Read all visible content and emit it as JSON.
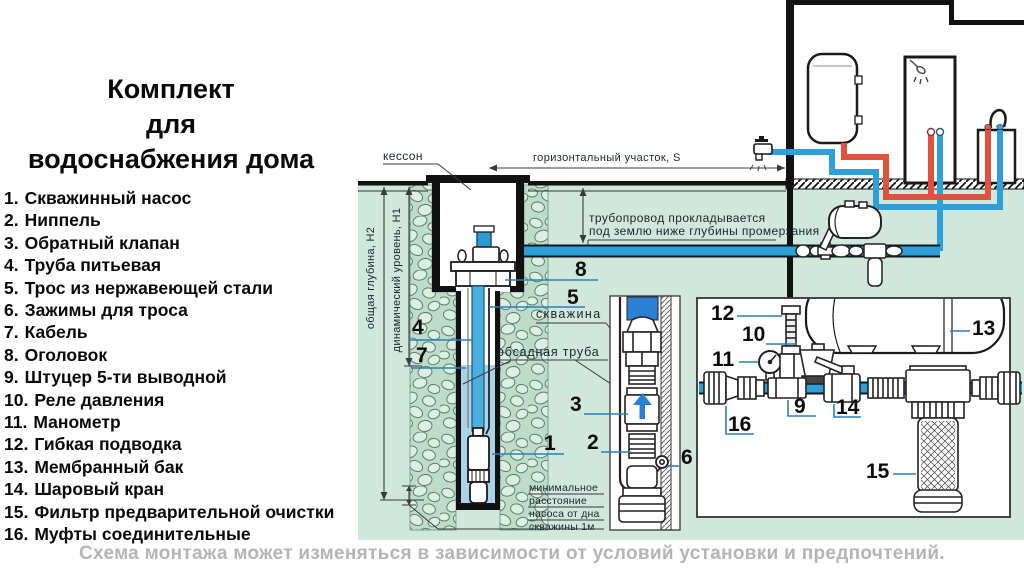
{
  "title": {
    "lines": [
      "Комплект",
      "для",
      "водоснабжения дома"
    ]
  },
  "parts_list": [
    {
      "num": "1.",
      "label": "Скважинный насос"
    },
    {
      "num": "2.",
      "label": "Ниппель"
    },
    {
      "num": "3.",
      "label": "Обратный клапан"
    },
    {
      "num": "4.",
      "label": "Труба питьевая"
    },
    {
      "num": "5.",
      "label": "Трос из нержавеющей стали"
    },
    {
      "num": "6.",
      "label": "Зажимы для троса"
    },
    {
      "num": "7.",
      "label": "Кабель"
    },
    {
      "num": "8.",
      "label": "Оголовок"
    },
    {
      "num": "9.",
      "label": "Штуцер 5-ти выводной"
    },
    {
      "num": "10.",
      "label": "Реле давления"
    },
    {
      "num": "11.",
      "label": "Манометр"
    },
    {
      "num": "12.",
      "label": "Гибкая подводка"
    },
    {
      "num": "13.",
      "label": "Мембранный бак"
    },
    {
      "num": "14.",
      "label": "Шаровый кран"
    },
    {
      "num": "15.",
      "label": "Фильтр предварительной очистки"
    },
    {
      "num": "16.",
      "label": "Муфты соединительные"
    }
  ],
  "diagram": {
    "labels": {
      "kesson": "кессон",
      "horizontal_section": "горизонтальный участок, S",
      "pipe_note_1": "трубопровод прокладывается",
      "pipe_note_2": "под землю ниже глубины промерзания",
      "well": "скважина",
      "casing": "обсадная труба",
      "total_depth": "общая глубина, Н2",
      "dynamic_level": "динамический уровень, Н1",
      "min_dist_1": "минимальное",
      "min_dist_2": "расстояние",
      "min_dist_3": "насоса от дна",
      "min_dist_4": "скважины 1м"
    },
    "callouts": {
      "c1": "1",
      "c2": "2",
      "c3": "3",
      "c4": "4",
      "c5": "5",
      "c6": "6",
      "c7": "7",
      "c8": "8",
      "c9": "9",
      "c10": "10",
      "c11": "11",
      "c12": "12",
      "c13": "13",
      "c14": "14",
      "c15": "15",
      "c16": "16"
    }
  },
  "footer": {
    "note": "Схема монтажа может изменяться в зависимости от условий установки и предпочтений."
  },
  "colors": {
    "underground_green": "#cfe8db",
    "pipe_cold_blue": "#2e9fd8",
    "pipe_hot_red": "#e2503e",
    "detail_pipe_blue": "#2b7fd4",
    "water_light_blue": "#aad4e6",
    "leader_blue": "#2980b9",
    "footer_gray": "#b5b5b5"
  }
}
